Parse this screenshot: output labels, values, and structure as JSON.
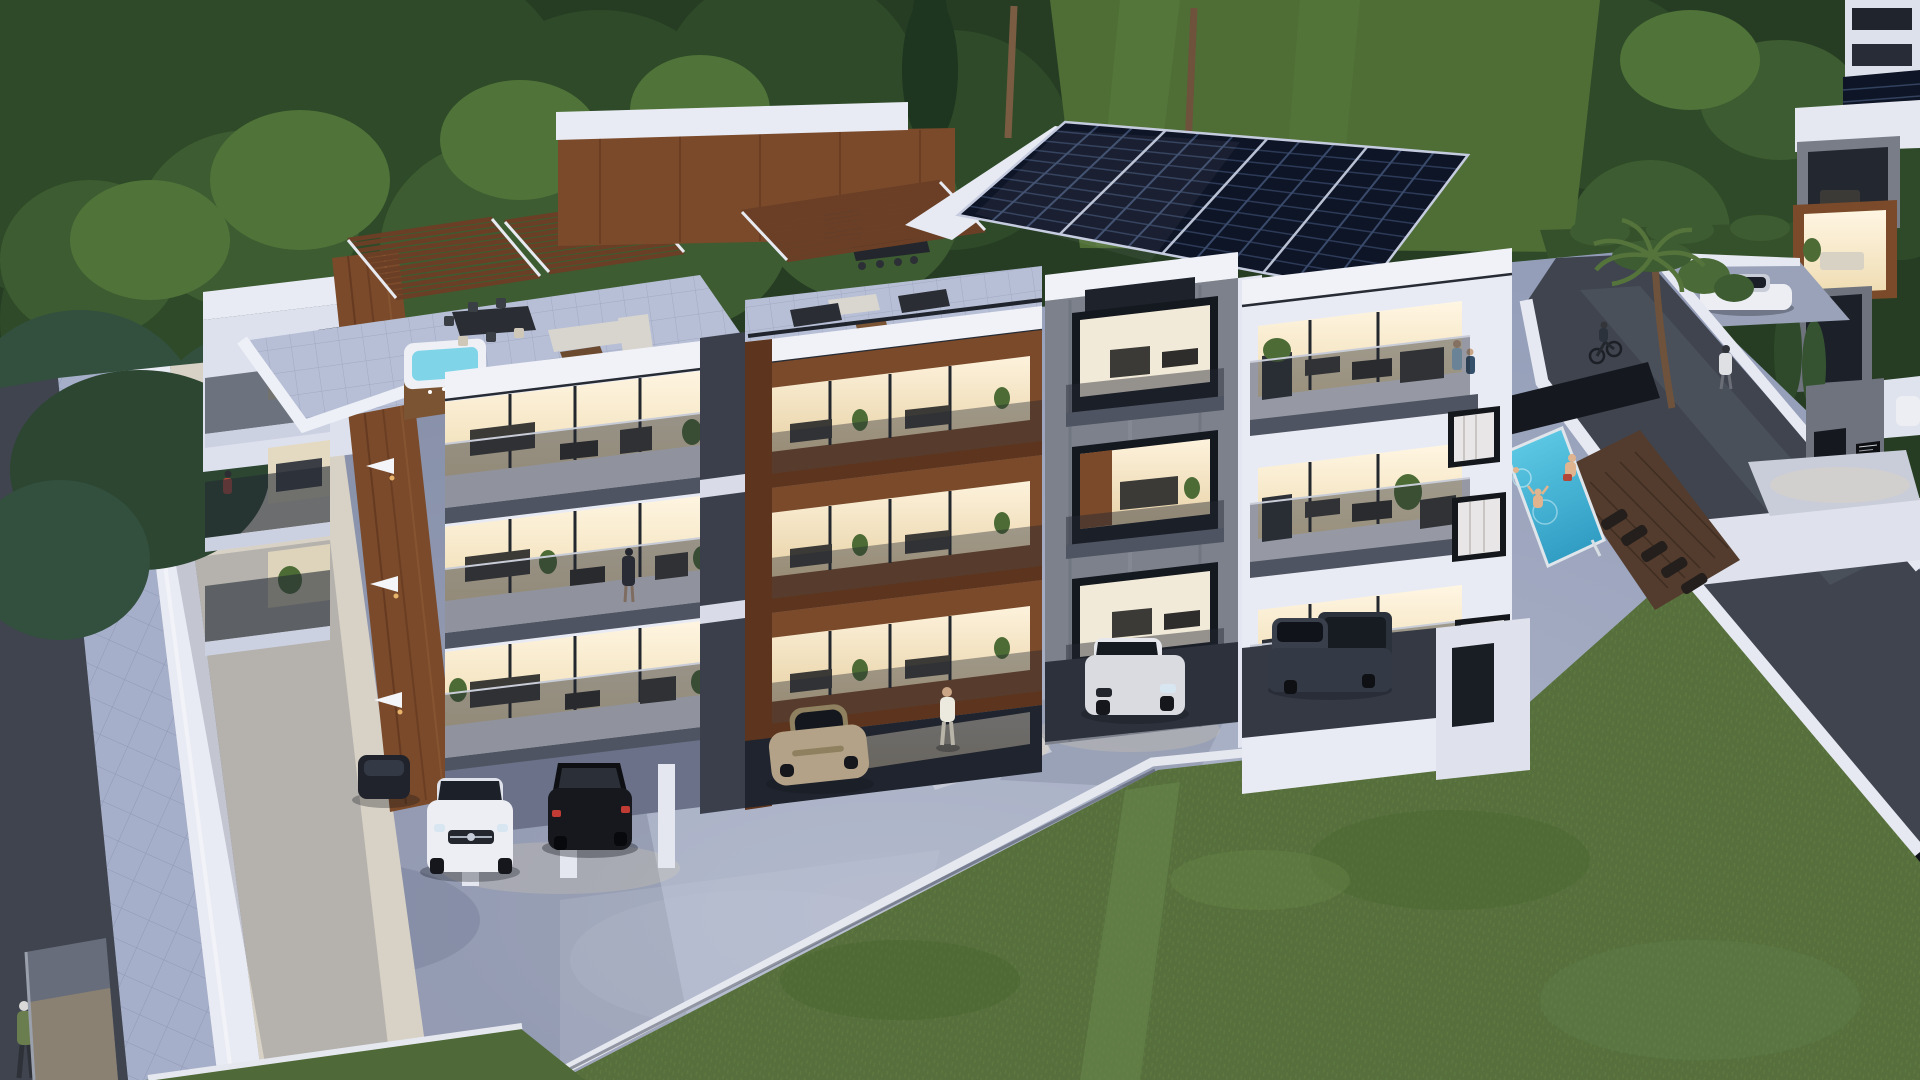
{
  "scene": {
    "title": "Modern apartment complex at dusk — aerial 3D architectural render",
    "setting": "four-storey residential block with wood accents, glowing balconies, rooftop terraces, solar panels, pool and landscaped grounds",
    "time_of_day": "dusk",
    "view": "elevated three-quarter aerial view"
  },
  "palette": {
    "treeBase": "#263d23",
    "treeDark": "#2e4a28",
    "treeMid": "#3d5c31",
    "treeLight": "#507339",
    "lawnTop": "#4e6e36",
    "hedge": "#35512c",
    "grassField": "#566f3c",
    "grassLight": "#69864b",
    "pond": "#23404e",
    "concrete": "#9ba4bd",
    "concreteLight": "#c3c7d4",
    "concreteShadow": "#6f7892",
    "asphalt": "#3f444e",
    "sidewalk": "#a6afc9",
    "courtyard": "#d8d2c6",
    "wallWhite": "#e9ebf4",
    "wallShaded": "#c7ccdf",
    "wood": "#7a4a2a",
    "woodDark": "#5d341d",
    "glassDark": "#1f252e",
    "warmLight": "#f7ead0",
    "warmBright": "#fdf4e2",
    "solar": "#0e1526",
    "solarLine": "#32425f",
    "pool": "#45bede",
    "deck": "#533c2d",
    "slabGray": "#4e5461",
    "grayTower": "#7c818c",
    "carWhite": "#eceef3",
    "carBlack": "#17181d",
    "carChampagne": "#b3a287",
    "carSilver": "#d9dbe0",
    "carPickup": "#39404b",
    "skin": "#e0b48e"
  },
  "inventory": {
    "buildings": {
      "main": "four-storey apartment block, white render with walnut wood bands and glass balustrades",
      "left_roof_terrace": "pergola deck with hot tub, dining table and L-shaped lounge sofa",
      "middle_roof_terrace": "pergola deck with bar counter, benches and coffee tables",
      "gray_tower": "exposed-concrete stair tower with three lit loggias, middle one wood lined",
      "right_wing": "white wing with three lit furnished balconies and curtained windows",
      "neighbour_building": "second block across the ramp with solar roof and lit wood loggia"
    },
    "amenities": [
      "rooftop-solar-arrays",
      "swimming-pool",
      "pool-deck-loungers",
      "hot-tub",
      "pergolas",
      "palm-trees",
      "entrance-ramp-road",
      "perimeter-walls",
      "entrance-sign-plate"
    ],
    "vehicles": [
      "partially hidden dark car under left pilotis",
      "white SUV parked under left pilotis",
      "black hatchback parked under left pilotis",
      "champagne sports coupe under centre block",
      "white SUV on the forecourt",
      "dark grey pickup truck under right wing",
      "white hatchback on upper parking pad",
      "white car glimpsed at neighbour building"
    ],
    "people": [
      "man walking at the lit entrance",
      "woman standing on a first-floor balcony",
      "resident on a left side balcony",
      "couple standing on the right top-floor balcony",
      "cyclist on the entrance ramp",
      "pedestrian walking up the ramp",
      "walker on the bottom-left pavement",
      "bather sitting at the pool edge",
      "swimmer jumping into the pool",
      "child swimming in the pool"
    ]
  },
  "counts": {
    "vehicles": 8,
    "people": 10,
    "pergolas": 3,
    "solar_arrays": 2,
    "lit_balcony_floors": 3,
    "palm_trees": 3,
    "pools": 1,
    "hot_tubs": 1
  }
}
